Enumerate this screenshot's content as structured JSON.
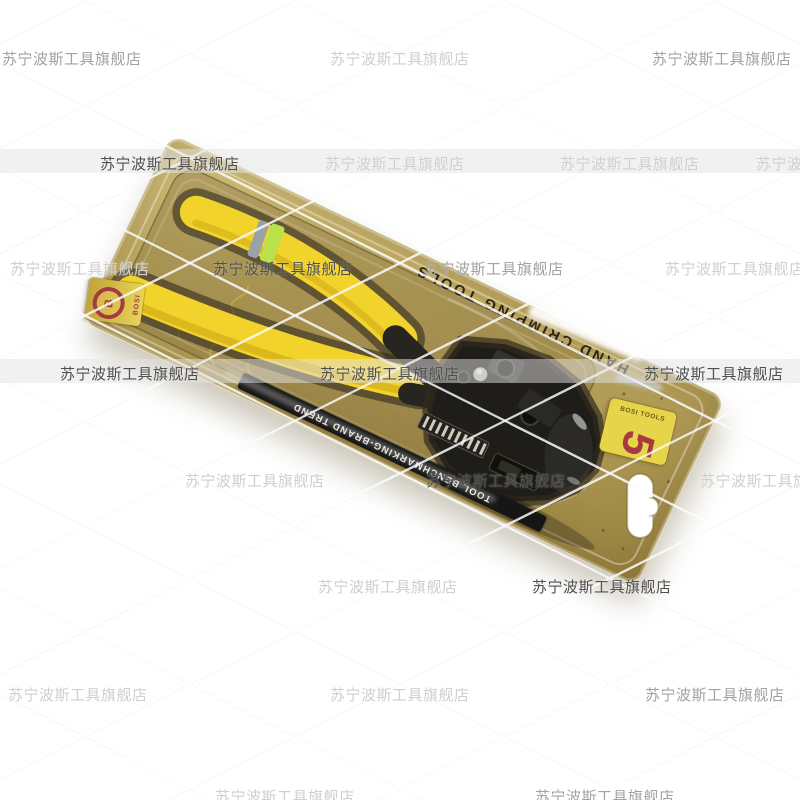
{
  "page": {
    "background": "#ffffff"
  },
  "watermark": {
    "text": "苏宁波斯工具旗舰店",
    "tones": {
      "dark": "#4f4f4f",
      "medium": "#a2a2a2",
      "light": "#cfcfcf"
    },
    "rows": [
      {
        "y": 48,
        "band": false,
        "items": [
          {
            "x": 2,
            "tone": "medium"
          },
          {
            "x": 330,
            "tone": "light"
          },
          {
            "x": 652,
            "tone": "medium"
          }
        ]
      },
      {
        "y": 153,
        "band": true,
        "items": [
          {
            "x": 100,
            "tone": "dark"
          },
          {
            "x": 325,
            "tone": "light"
          },
          {
            "x": 560,
            "tone": "light"
          },
          {
            "x": 756,
            "tone": "light"
          }
        ]
      },
      {
        "y": 258,
        "band": false,
        "items": [
          {
            "x": 10,
            "tone": "light"
          },
          {
            "x": 213,
            "tone": "dark"
          },
          {
            "x": 424,
            "tone": "medium"
          },
          {
            "x": 665,
            "tone": "light"
          }
        ]
      },
      {
        "y": 363,
        "band": true,
        "items": [
          {
            "x": 60,
            "tone": "dark"
          },
          {
            "x": 320,
            "tone": "dark"
          },
          {
            "x": 644,
            "tone": "dark"
          }
        ]
      },
      {
        "y": 470,
        "band": false,
        "items": [
          {
            "x": 185,
            "tone": "light"
          },
          {
            "x": 426,
            "tone": "dark"
          },
          {
            "x": 700,
            "tone": "light"
          }
        ]
      },
      {
        "y": 576,
        "band": false,
        "items": [
          {
            "x": 318,
            "tone": "light"
          },
          {
            "x": 532,
            "tone": "dark"
          }
        ]
      },
      {
        "y": 684,
        "band": false,
        "items": [
          {
            "x": 8,
            "tone": "light"
          },
          {
            "x": 330,
            "tone": "light"
          },
          {
            "x": 645,
            "tone": "medium"
          }
        ]
      },
      {
        "y": 786,
        "band": false,
        "items": [
          {
            "x": 215,
            "tone": "light"
          },
          {
            "x": 535,
            "tone": "medium"
          }
        ]
      }
    ]
  },
  "package": {
    "card_text_top": "HAND CRIMPING TOOLS",
    "strip_text": "TOOL BENCHMARKING-BRAND TREND",
    "right_sticker": {
      "big_glyph": "5",
      "side_text": "BOSI TOOLS"
    },
    "left_sticker": {
      "emblem_letter": "B",
      "side_text": "BOSI"
    },
    "colors": {
      "card_light": "#d8c685",
      "card_mid": "#b8a55e",
      "card_dark": "#97823f",
      "tray": "#8f7d45",
      "recess": "#3f3a2c",
      "handle_yellow": "#f2d32b",
      "handle_yellow_dark": "#c9a414",
      "stripe_green": "#b9e24d",
      "stripe_gray": "#9aa2a8",
      "metal_dark": "#1e1d1a",
      "metal_mid": "#3a3933",
      "strip_bg": "#161616",
      "strip_text_color": "#e8e4d8",
      "sticker_yellow": "#e6d44a",
      "sticker_red": "#a63a42",
      "emboss_gold": "#caa93c"
    }
  }
}
